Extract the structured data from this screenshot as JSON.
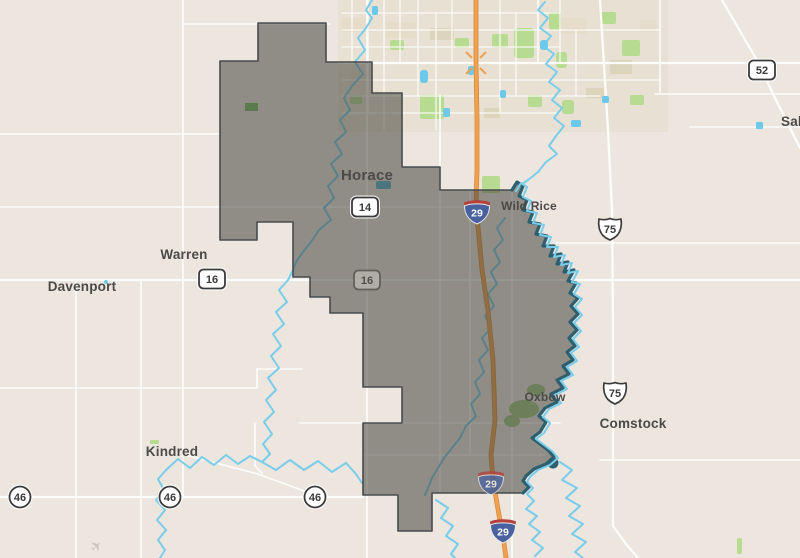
{
  "map": {
    "description": "road-map with dark municipal boundary overlay south of Fargo ND",
    "towns": {
      "horace": "Horace",
      "wild_rice": "Wild Rice",
      "warren": "Warren",
      "davenport": "Davenport",
      "kindred": "Kindred",
      "oxbow": "Oxbow",
      "comstock": "Comstock",
      "sabin_partial": "Sab"
    },
    "shields": {
      "interstate_29": "29",
      "us_75": "75",
      "county_14": "14",
      "county_16": "16",
      "county_46": "46",
      "county_52": "52"
    },
    "colors": {
      "background": "#ece6df",
      "urban_block": "#e5dcc9",
      "park_green": "#b7db90",
      "water_blue": "#79cdeb",
      "deep_water_teal": "#2d5f6f",
      "road_white": "#fcfcfa",
      "interstate_orange": "#f0a14f",
      "boundary_fill_gray": "#44433c",
      "interstate_shield_blue": "#49629f",
      "interstate_shield_red": "#b6403a",
      "label_gray": "#4c4a47"
    }
  }
}
